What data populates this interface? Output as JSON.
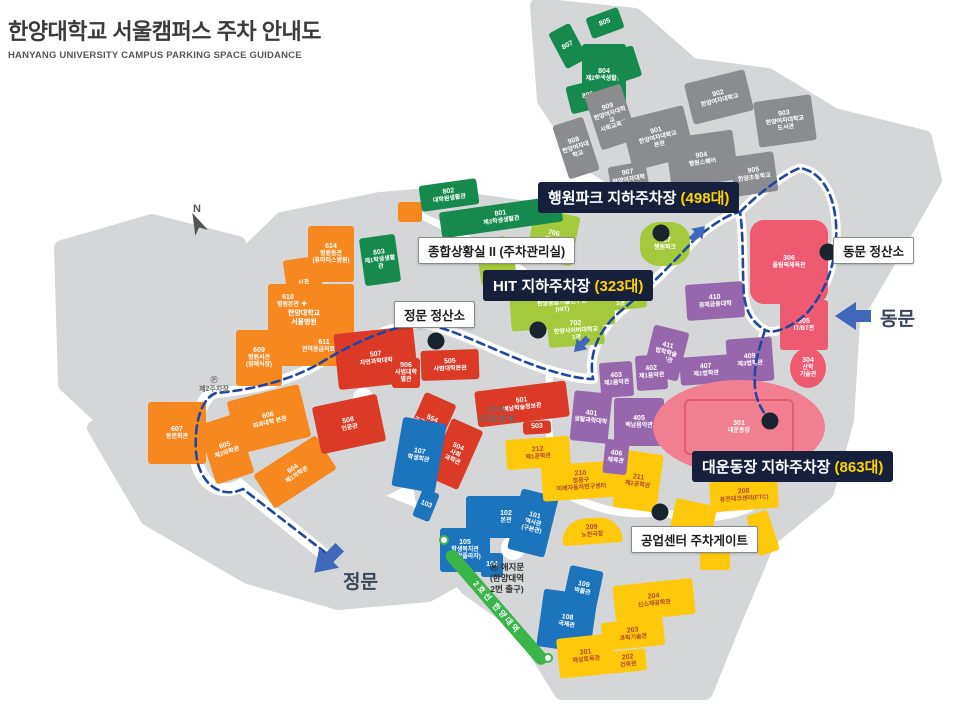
{
  "header": {
    "title": "한양대학교 서울캠퍼스 주차 안내도",
    "subtitle": "HANYANG UNIVERSITY CAMPUS PARKING SPACE GUIDANCE"
  },
  "map": {
    "palette": {
      "orange": "#F6881F",
      "red": "#DA3A26",
      "blue": "#1C75BC",
      "yellow": "#FFC90B",
      "purple": "#9767AE",
      "pink": "#EF5A73",
      "pink_light": "#F27E92",
      "lime": "#A4C93C",
      "green": "#168A4E",
      "gray": "#8A8C90",
      "none": "transparent"
    },
    "route_color": "#2146A0",
    "ground_color": "#D5D6D8",
    "callouts": [
      {
        "id": "haengwon-park-parking",
        "text": "행원파크 지하주차장 ",
        "count": "(498대)",
        "x": 538,
        "y": 182
      },
      {
        "id": "hit-parking",
        "text": "HIT 지하주차장 ",
        "count": "(323대)",
        "x": 483,
        "y": 270
      },
      {
        "id": "stadium-parking",
        "text": "대운동장 지하주차장 ",
        "count": "(863대)",
        "x": 692,
        "y": 451
      }
    ],
    "booths": [
      {
        "id": "parking-control-room",
        "text": "종합상황실 II (주차관리실)",
        "x": 418,
        "y": 237
      },
      {
        "id": "main-gate-tollbooth",
        "text": "정문 정산소",
        "x": 394,
        "y": 301
      },
      {
        "id": "east-gate-tollbooth",
        "text": "동문 정산소",
        "x": 833,
        "y": 237
      },
      {
        "id": "industry-center-gate",
        "text": "공업센터 주차게이트",
        "x": 631,
        "y": 526
      }
    ],
    "gates": [
      {
        "id": "east-gate",
        "label": "동문",
        "x": 880,
        "y": 304
      },
      {
        "id": "main-gate",
        "label": "정문",
        "x": 343,
        "y": 567
      }
    ],
    "dots": [
      {
        "x": 436,
        "y": 341
      },
      {
        "x": 538,
        "y": 330
      },
      {
        "x": 661,
        "y": 233
      },
      {
        "x": 828,
        "y": 252
      },
      {
        "x": 770,
        "y": 421
      },
      {
        "x": 660,
        "y": 512
      }
    ],
    "subway_label": "2호선 한양대역",
    "misc": [
      {
        "cls": "note",
        "x": 464,
        "y": 406,
        "w": 64,
        "lines": [
          "사자가",
          "군것질 할 때"
        ]
      },
      {
        "cls": "note",
        "x": 182,
        "y": 376,
        "w": 64,
        "lines": [
          "Ⓟ",
          "제2주차장"
        ]
      },
      {
        "cls": "landmark",
        "x": 468,
        "y": 562,
        "w": 78,
        "lines": [
          "Ⓜ 애지문",
          "(한양대역",
          "2번 출구)"
        ]
      },
      {
        "cls": "hospital",
        "x": 262,
        "y": 300,
        "w": 84,
        "lines": [
          "✚",
          "한양대학교",
          "서울병원"
        ]
      },
      {
        "cls": "compass",
        "x": 182,
        "y": 202,
        "w": 30,
        "lines": [
          "N"
        ]
      }
    ],
    "buildings": [
      {
        "n": "",
        "t": [
          "신관"
        ],
        "c": "orange",
        "x": 286,
        "y": 258,
        "w": 36,
        "h": 50,
        "r": -8
      },
      {
        "n": "614",
        "t": [
          "병원동관",
          "(류마티스병원)"
        ],
        "c": "orange",
        "x": 308,
        "y": 226,
        "w": 46,
        "h": 56,
        "r": 0
      },
      {
        "n": "",
        "t": [],
        "c": "orange",
        "x": 268,
        "y": 284,
        "w": 86,
        "h": 82,
        "r": 0
      },
      {
        "n": "610",
        "t": [
          "병원본관"
        ],
        "c": "none",
        "x": 262,
        "y": 290,
        "w": 52,
        "h": 22,
        "r": 0
      },
      {
        "n": "611",
        "t": [
          "권역응급의료센터"
        ],
        "c": "none",
        "x": 292,
        "y": 336,
        "w": 64,
        "h": 20,
        "r": 0
      },
      {
        "n": "609",
        "t": [
          "병원서관",
          "(장례식장)"
        ],
        "c": "orange",
        "x": 236,
        "y": 330,
        "w": 46,
        "h": 56,
        "r": 0
      },
      {
        "n": "607",
        "t": [
          "동문회관"
        ],
        "c": "orange",
        "x": 148,
        "y": 402,
        "w": 58,
        "h": 62,
        "r": 0
      },
      {
        "n": "606",
        "t": [
          "의과대학 본관"
        ],
        "c": "orange",
        "x": 232,
        "y": 392,
        "w": 74,
        "h": 54,
        "r": -14
      },
      {
        "n": "605",
        "t": [
          "제2의학관"
        ],
        "c": "orange",
        "x": 206,
        "y": 418,
        "w": 40,
        "h": 62,
        "r": -18
      },
      {
        "n": "604",
        "t": [
          "제1의학관"
        ],
        "c": "orange",
        "x": 258,
        "y": 452,
        "w": 74,
        "h": 40,
        "r": -33
      },
      {
        "n": "",
        "t": [],
        "c": "orange",
        "x": 398,
        "y": 202,
        "w": 24,
        "h": 20,
        "r": 0
      },
      {
        "n": "507",
        "t": [
          "자연과학대학"
        ],
        "c": "red",
        "x": 336,
        "y": 330,
        "w": 80,
        "h": 56,
        "r": -6
      },
      {
        "n": "506",
        "t": [
          "사범대학",
          "별관"
        ],
        "c": "red",
        "x": 392,
        "y": 358,
        "w": 28,
        "h": 30,
        "r": 0
      },
      {
        "n": "505",
        "t": [
          "사범대학본관"
        ],
        "c": "red",
        "x": 421,
        "y": 350,
        "w": 58,
        "h": 30,
        "r": -2
      },
      {
        "n": "501",
        "t": [
          "백남학술정보관"
        ],
        "c": "red",
        "x": 476,
        "y": 386,
        "w": 92,
        "h": 36,
        "r": -7
      },
      {
        "n": "554",
        "t": [
          "공공정책대학원"
        ],
        "c": "red",
        "x": 412,
        "y": 396,
        "w": 34,
        "h": 60,
        "r": 24
      },
      {
        "n": "504",
        "t": [
          "사회",
          "과학관"
        ],
        "c": "red",
        "x": 438,
        "y": 422,
        "w": 34,
        "h": 64,
        "r": 24
      },
      {
        "n": "508",
        "t": [
          "인문관"
        ],
        "c": "red",
        "x": 316,
        "y": 400,
        "w": 66,
        "h": 48,
        "r": -12
      },
      {
        "n": "503",
        "t": [],
        "c": "red",
        "x": 523,
        "y": 421,
        "w": 28,
        "h": 13,
        "r": -3
      },
      {
        "n": "107",
        "t": [
          "학생회관"
        ],
        "c": "blue",
        "x": 397,
        "y": 420,
        "w": 44,
        "h": 70,
        "r": 10
      },
      {
        "n": "103",
        "t": [],
        "c": "blue",
        "x": 417,
        "y": 490,
        "w": 18,
        "h": 30,
        "r": 22
      },
      {
        "n": "102",
        "t": [
          "본관"
        ],
        "c": "blue",
        "x": 466,
        "y": 496,
        "w": 80,
        "h": 42,
        "r": 0
      },
      {
        "n": "105",
        "t": [
          "학생복지관",
          "(한양플라자)"
        ],
        "c": "blue",
        "x": 440,
        "y": 528,
        "w": 50,
        "h": 44,
        "r": 0
      },
      {
        "n": "101",
        "t": [
          "역사관",
          "(구본관)"
        ],
        "c": "blue",
        "x": 514,
        "y": 492,
        "w": 38,
        "h": 62,
        "r": 14
      },
      {
        "n": "104",
        "t": [],
        "c": "blue",
        "x": 481,
        "y": 553,
        "w": 22,
        "h": 24,
        "r": 0
      },
      {
        "n": "109",
        "t": [
          "박물관"
        ],
        "c": "blue",
        "x": 566,
        "y": 568,
        "w": 34,
        "h": 40,
        "r": 12
      },
      {
        "n": "108",
        "t": [
          "국제관"
        ],
        "c": "blue",
        "x": 540,
        "y": 592,
        "w": 54,
        "h": 58,
        "r": 8
      },
      {
        "n": "212",
        "t": [
          "제1공학관"
        ],
        "c": "yellow",
        "x": 506,
        "y": 438,
        "w": 64,
        "h": 30,
        "r": -4
      },
      {
        "n": "210",
        "t": [
          "정몽구",
          "미래자동차연구센터"
        ],
        "c": "yellow",
        "x": 542,
        "y": 463,
        "w": 78,
        "h": 36,
        "r": -4
      },
      {
        "n": "211",
        "t": [
          "제2공학관"
        ],
        "c": "yellow",
        "x": 616,
        "y": 452,
        "w": 44,
        "h": 58,
        "r": 8
      },
      {
        "n": "209",
        "t": [
          "노천극장"
        ],
        "c": "yellow",
        "x": 562,
        "y": 518,
        "w": 60,
        "h": 26,
        "r": -4,
        "rd": "30px 30px 4px 4px"
      },
      {
        "n": "208",
        "t": [
          "퓨전테크센터(FTC)"
        ],
        "c": "yellow",
        "x": 710,
        "y": 480,
        "w": 68,
        "h": 30,
        "r": -4
      },
      {
        "n": "204",
        "t": [
          "신소재공학관"
        ],
        "c": "yellow",
        "x": 614,
        "y": 582,
        "w": 80,
        "h": 36,
        "r": -6
      },
      {
        "n": "203",
        "t": [
          "과학기술관"
        ],
        "c": "yellow",
        "x": 602,
        "y": 620,
        "w": 62,
        "h": 28,
        "r": -6
      },
      {
        "n": "202",
        "t": [
          "건축관"
        ],
        "c": "yellow",
        "x": 610,
        "y": 650,
        "w": 36,
        "h": 22,
        "r": -6
      },
      {
        "n": "201",
        "t": [
          "재성토목관"
        ],
        "c": "yellow",
        "x": 558,
        "y": 636,
        "w": 56,
        "h": 40,
        "r": -6
      },
      {
        "n": "",
        "t": [],
        "c": "yellow",
        "x": 672,
        "y": 502,
        "w": 42,
        "h": 38,
        "r": 12
      },
      {
        "n": "",
        "t": [],
        "c": "yellow",
        "x": 700,
        "y": 544,
        "w": 30,
        "h": 26,
        "r": 0
      },
      {
        "n": "",
        "t": [],
        "c": "yellow",
        "x": 752,
        "y": 512,
        "w": 22,
        "h": 42,
        "r": -18
      },
      {
        "n": "410",
        "t": [
          "경제금융대학"
        ],
        "c": "purple",
        "x": 686,
        "y": 283,
        "w": 58,
        "h": 36,
        "r": -4
      },
      {
        "n": "411",
        "t": [
          "법학학술",
          "정보관"
        ],
        "c": "purple",
        "x": 648,
        "y": 328,
        "w": 36,
        "h": 50,
        "r": 14
      },
      {
        "n": "407",
        "t": [
          "제1법학관"
        ],
        "c": "purple",
        "x": 680,
        "y": 356,
        "w": 52,
        "h": 28,
        "r": -4
      },
      {
        "n": "409",
        "t": [
          "제3법학관"
        ],
        "c": "purple",
        "x": 727,
        "y": 338,
        "w": 46,
        "h": 44,
        "r": -4
      },
      {
        "n": "408",
        "t": [
          "제2법학관"
        ],
        "c": "purple",
        "x": 694,
        "y": 388,
        "w": 46,
        "h": 26,
        "r": -4
      },
      {
        "n": "403",
        "t": [
          "제2음악관"
        ],
        "c": "purple",
        "x": 600,
        "y": 362,
        "w": 33,
        "h": 35,
        "r": -4
      },
      {
        "n": "402",
        "t": [
          "제1음악관"
        ],
        "c": "purple",
        "x": 636,
        "y": 355,
        "w": 31,
        "h": 35,
        "r": -4
      },
      {
        "n": "401",
        "t": [
          "생활과학대학"
        ],
        "c": "purple",
        "x": 572,
        "y": 392,
        "w": 38,
        "h": 50,
        "r": 6
      },
      {
        "n": "405",
        "t": [
          "백남음악관"
        ],
        "c": "purple",
        "x": 614,
        "y": 398,
        "w": 50,
        "h": 48,
        "r": 0
      },
      {
        "n": "406",
        "t": [
          "체육관"
        ],
        "c": "purple",
        "x": 604,
        "y": 440,
        "w": 24,
        "h": 34,
        "r": 6
      },
      {
        "n": "306",
        "t": [
          "올림픽체육관"
        ],
        "c": "pink",
        "x": 750,
        "y": 220,
        "w": 78,
        "h": 84,
        "r": 0,
        "rd": "14px"
      },
      {
        "n": "305",
        "t": [
          "IT/BT관"
        ],
        "c": "pink",
        "x": 780,
        "y": 300,
        "w": 48,
        "h": 50,
        "r": 0
      },
      {
        "n": "304",
        "t": [
          "산학",
          "기술관"
        ],
        "c": "pink",
        "x": 790,
        "y": 348,
        "w": 36,
        "h": 40,
        "r": 0,
        "rd": "50%"
      },
      {
        "n": "301",
        "t": [
          "대운동장"
        ],
        "c": "pink_light",
        "x": 653,
        "y": 380,
        "w": 172,
        "h": 94,
        "r": 0,
        "rd": "50%",
        "field": true
      },
      {
        "n": "706",
        "t": [
          "경영관"
        ],
        "c": "lime",
        "x": 530,
        "y": 212,
        "w": 46,
        "h": 50,
        "r": 12
      },
      {
        "n": "707",
        "t": [
          "행원파크"
        ],
        "c": "lime",
        "x": 640,
        "y": 222,
        "w": 50,
        "h": 44,
        "r": 0,
        "rd": "40%"
      },
      {
        "n": "701",
        "t": [
          "한양종합기술연구원",
          "(HIT)"
        ],
        "c": "lime",
        "x": 510,
        "y": 278,
        "w": 104,
        "h": 50,
        "r": -4
      },
      {
        "n": "702",
        "t": [
          "한양사이버대학교",
          "1관"
        ],
        "c": "lime",
        "x": 548,
        "y": 316,
        "w": 56,
        "h": 30,
        "r": -4
      },
      {
        "n": "703",
        "t": [
          "한양사이버대학교",
          "2관"
        ],
        "c": "lime",
        "x": 594,
        "y": 284,
        "w": 52,
        "h": 26,
        "r": -6
      },
      {
        "n": "",
        "t": [],
        "c": "lime",
        "x": 480,
        "y": 260,
        "w": 36,
        "h": 24,
        "r": -8
      },
      {
        "n": "",
        "t": [],
        "c": "lime",
        "x": 497,
        "y": 238,
        "w": 30,
        "h": 20,
        "r": 10
      },
      {
        "n": "803",
        "t": [
          "제1학생생활관"
        ],
        "c": "green",
        "x": 362,
        "y": 236,
        "w": 36,
        "h": 48,
        "r": -8
      },
      {
        "n": "802",
        "t": [
          "대학원생활관"
        ],
        "c": "green",
        "x": 420,
        "y": 182,
        "w": 58,
        "h": 26,
        "r": -8
      },
      {
        "n": "801",
        "t": [
          "제3학생생활관"
        ],
        "c": "green",
        "x": 440,
        "y": 204,
        "w": 122,
        "h": 26,
        "r": -8
      },
      {
        "n": "807",
        "t": [],
        "c": "green",
        "x": 556,
        "y": 26,
        "w": 24,
        "h": 40,
        "r": -28
      },
      {
        "n": "805",
        "t": [],
        "c": "green",
        "x": 588,
        "y": 12,
        "w": 34,
        "h": 22,
        "r": -20
      },
      {
        "n": "804",
        "t": [
          "제2학생생활관"
        ],
        "c": "green",
        "x": 582,
        "y": 44,
        "w": 44,
        "h": 62,
        "r": 0
      },
      {
        "n": "806",
        "t": [],
        "c": "green",
        "x": 568,
        "y": 82,
        "w": 40,
        "h": 28,
        "r": -14
      },
      {
        "n": "",
        "t": [],
        "c": "green",
        "x": 614,
        "y": 48,
        "w": 24,
        "h": 32,
        "r": -18
      },
      {
        "n": "909",
        "t": [
          "한양여자대학교",
          "사회교육관"
        ],
        "c": "gray",
        "x": 592,
        "y": 88,
        "w": 38,
        "h": 58,
        "r": -18
      },
      {
        "n": "901",
        "t": [
          "한양여자대학교",
          "본관"
        ],
        "c": "gray",
        "x": 626,
        "y": 112,
        "w": 64,
        "h": 52,
        "r": -14
      },
      {
        "n": "902",
        "t": [
          "한양여자대학교"
        ],
        "c": "gray",
        "x": 688,
        "y": 76,
        "w": 62,
        "h": 42,
        "r": -14
      },
      {
        "n": "903",
        "t": [
          "한양여자대학교",
          "도서관"
        ],
        "c": "gray",
        "x": 756,
        "y": 98,
        "w": 58,
        "h": 46,
        "r": -8
      },
      {
        "n": "904",
        "t": [
          "행원스퀘어"
        ],
        "c": "gray",
        "x": 668,
        "y": 134,
        "w": 68,
        "h": 50,
        "r": -8
      },
      {
        "n": "905",
        "t": [
          "한양초등학교"
        ],
        "c": "gray",
        "x": 732,
        "y": 154,
        "w": 44,
        "h": 40,
        "r": -8
      },
      {
        "n": "907",
        "t": [
          "한양여자대학교"
        ],
        "c": "gray",
        "x": 610,
        "y": 164,
        "w": 38,
        "h": 32,
        "r": -10
      },
      {
        "n": "908",
        "t": [
          "한양여자대학교"
        ],
        "c": "gray",
        "x": 560,
        "y": 120,
        "w": 32,
        "h": 56,
        "r": -18
      }
    ]
  }
}
